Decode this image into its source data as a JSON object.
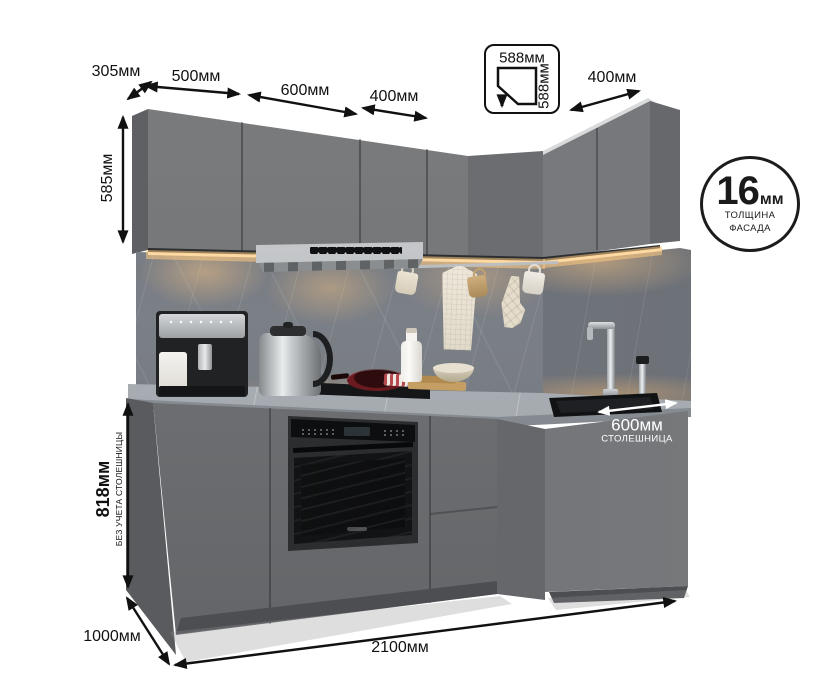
{
  "dimensions": {
    "top": {
      "depth": "305мм",
      "w1": "500мм",
      "w2": "600мм",
      "w3": "400мм",
      "right": "400мм"
    },
    "corner_badge": {
      "width": "588мм",
      "depth": "588мм"
    },
    "left": {
      "upper_height": "585мм",
      "base_height": "818мм",
      "base_height_note": "БЕЗ УЧЕТА СТОЛЕШНИЦЫ"
    },
    "bottom": {
      "total_width": "2100мм",
      "total_depth": "1000мм"
    },
    "countertop": {
      "depth": "600мм",
      "label": "СТОЛЕШНИЦА"
    },
    "facade": {
      "value": "16",
      "unit": "мм",
      "line1": "ТОЛЩИНА",
      "line2": "ФАСАДА"
    }
  },
  "colors": {
    "cabinet_front": "#737577",
    "cabinet_return": "#7b7d80",
    "backsplash_marble": "#757981",
    "countertop_marble": "#a7acb1",
    "led_strip": "#ffd9a2",
    "annotation": "#111111",
    "annotation_white": "#ffffff",
    "oven_black": "#121314",
    "pan_red": "#7a1d22"
  }
}
